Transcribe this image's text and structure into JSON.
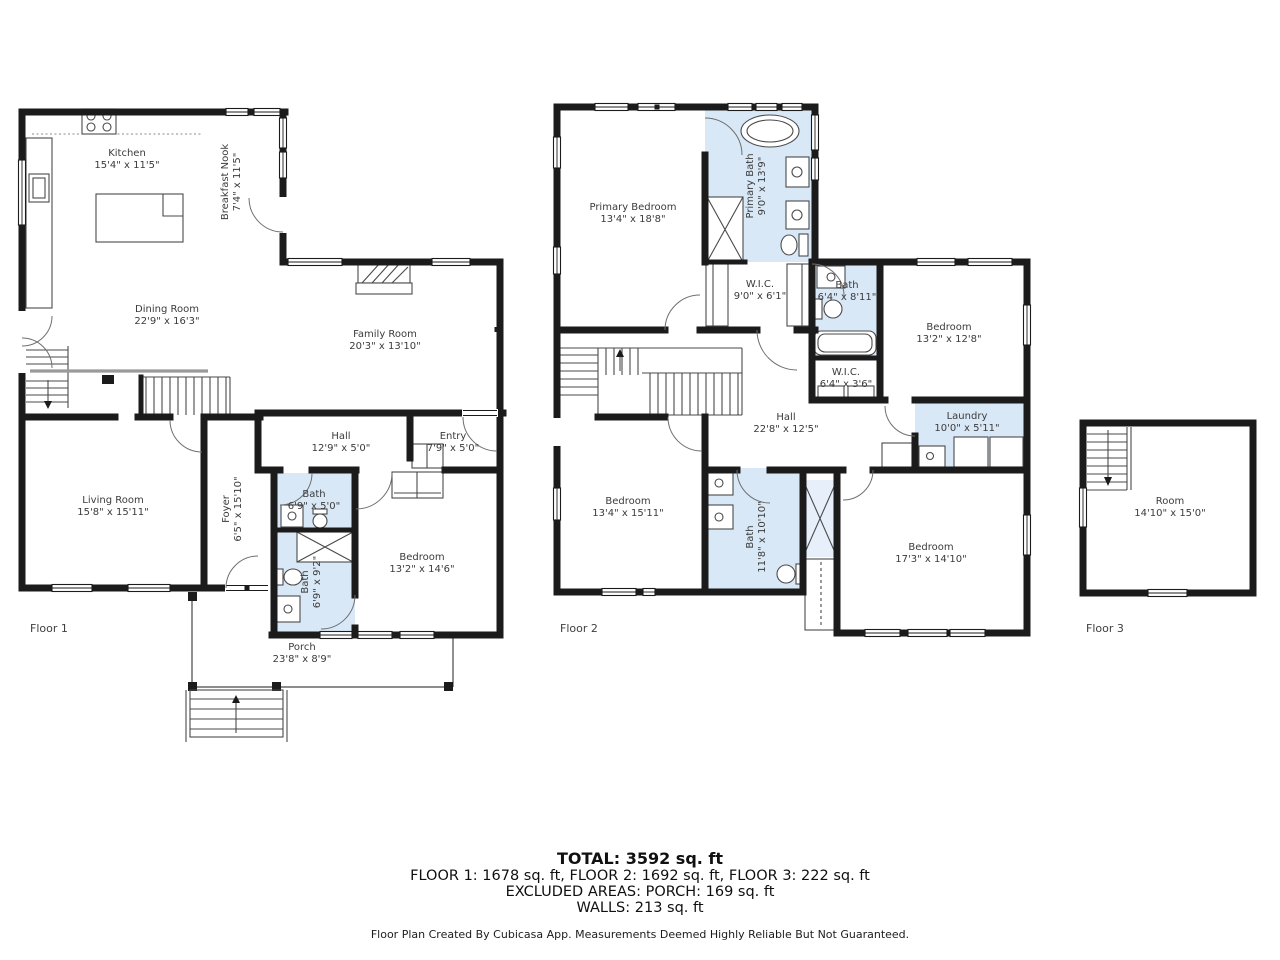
{
  "colors": {
    "wall": "#1b1b1b",
    "bath_fill": "#d9e8f6",
    "text": "#3b3b3b"
  },
  "floors": [
    {
      "label": "Floor 1",
      "rooms": [
        {
          "name": "Kitchen",
          "dims": "15'4\" x 11'5\""
        },
        {
          "name": "Breakfast Nook",
          "dims": "7'4\" x 11'5\""
        },
        {
          "name": "Dining Room",
          "dims": "22'9\" x 16'3\""
        },
        {
          "name": "Family Room",
          "dims": "20'3\" x 13'10\""
        },
        {
          "name": "Hall",
          "dims": "12'9\" x 5'0\""
        },
        {
          "name": "Entry",
          "dims": "7'9\" x 5'0\""
        },
        {
          "name": "Living Room",
          "dims": "15'8\" x 15'11\""
        },
        {
          "name": "Foyer",
          "dims": "6'5\" x 15'10\""
        },
        {
          "name": "Bath",
          "dims": "6'9\" x 5'0\""
        },
        {
          "name": "Bath",
          "dims": "6'9\" x 9'2\""
        },
        {
          "name": "Bedroom",
          "dims": "13'2\" x 14'6\""
        },
        {
          "name": "Porch",
          "dims": "23'8\" x 8'9\""
        }
      ]
    },
    {
      "label": "Floor 2",
      "rooms": [
        {
          "name": "Primary Bedroom",
          "dims": "13'4\" x 18'8\""
        },
        {
          "name": "Primary Bath",
          "dims": "9'0\" x 13'9\""
        },
        {
          "name": "W.I.C.",
          "dims": "9'0\" x 6'1\""
        },
        {
          "name": "Bath",
          "dims": "6'4\" x 8'11\""
        },
        {
          "name": "Bedroom",
          "dims": "13'2\" x 12'8\""
        },
        {
          "name": "W.I.C.",
          "dims": "6'4\" x 3'6\""
        },
        {
          "name": "Hall",
          "dims": "22'8\" x 12'5\""
        },
        {
          "name": "Laundry",
          "dims": "10'0\" x 5'11\""
        },
        {
          "name": "Bedroom",
          "dims": "13'4\" x 15'11\""
        },
        {
          "name": "Bath",
          "dims": "11'8\" x 10'10\""
        },
        {
          "name": "Bedroom",
          "dims": "17'3\" x 14'10\""
        }
      ]
    },
    {
      "label": "Floor 3",
      "rooms": [
        {
          "name": "Room",
          "dims": "14'10\" x 15'0\""
        }
      ]
    }
  ],
  "summary": {
    "total": "TOTAL: 3592 sq. ft",
    "floors_line": "FLOOR 1: 1678 sq. ft, FLOOR 2: 1692 sq. ft, FLOOR 3: 222 sq. ft",
    "excluded_line": "EXCLUDED AREAS: PORCH: 169 sq. ft",
    "walls_line": "WALLS: 213 sq. ft"
  },
  "disclaimer": "Floor Plan Created By Cubicasa App. Measurements Deemed Highly Reliable But Not Guaranteed."
}
